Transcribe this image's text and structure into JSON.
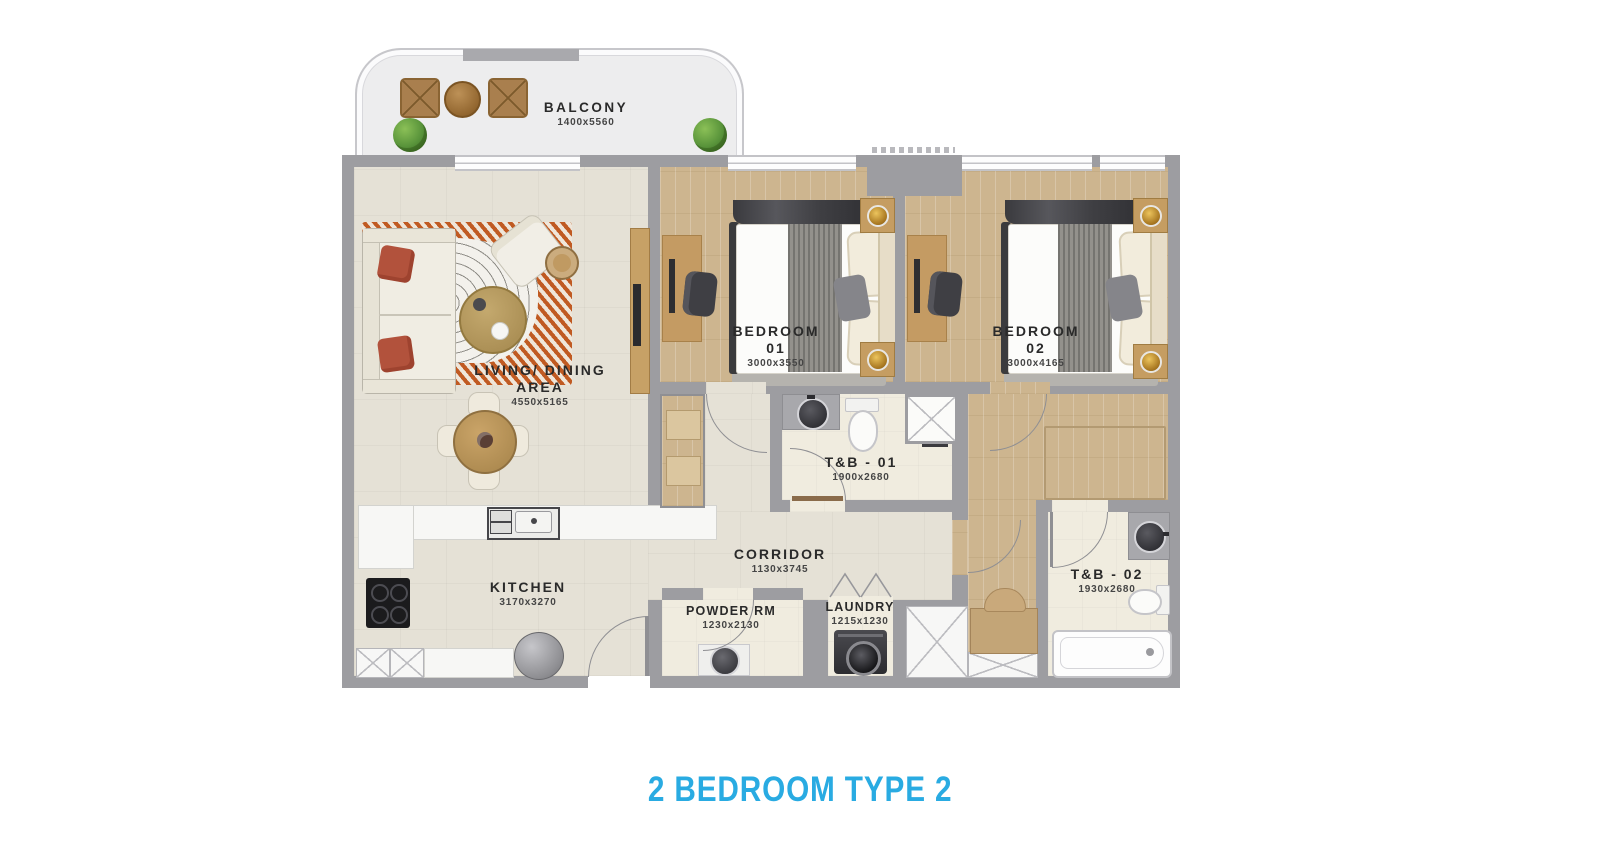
{
  "title": "2 BEDROOM TYPE 2",
  "rooms": {
    "balcony": {
      "name": "BALCONY",
      "dims": "1400x5560"
    },
    "living": {
      "line1": "LIVING/ DINING",
      "line2": "AREA",
      "dims": "4550x5165"
    },
    "kitchen": {
      "name": "KITCHEN",
      "dims": "3170x3270"
    },
    "bedroom1": {
      "name": "BEDROOM",
      "number": "01",
      "dims": "3000x3550"
    },
    "bedroom2": {
      "name": "BEDROOM",
      "number": "02",
      "dims": "3000x4165"
    },
    "tb1": {
      "name": "T&B - 01",
      "dims": "1900x2680"
    },
    "tb2": {
      "name": "T&B - 02",
      "dims": "1930x2680"
    },
    "corridor": {
      "name": "CORRIDOR",
      "dims": "1130x3745"
    },
    "powder": {
      "name": "POWDER RM",
      "dims": "1230x2130"
    },
    "laundry": {
      "name": "LAUNDRY",
      "dims": "1215x1230"
    }
  },
  "colors": {
    "accent": "#29abe2",
    "wall": "#9d9da1",
    "label": "#2a2a2a",
    "wood": "#cdb58f",
    "floor": "#e5e1d6"
  }
}
